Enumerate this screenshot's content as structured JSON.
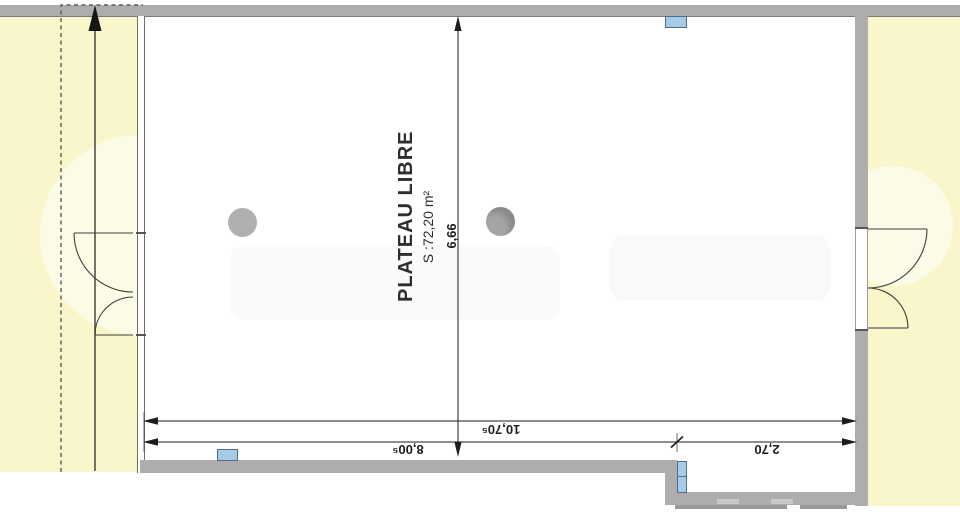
{
  "room": {
    "name": "PLATEAU LIBRE",
    "area": "S :72,20 m²"
  },
  "dimensions": {
    "height": "6,66",
    "total_width": "10,70⁵",
    "main_width": "8,00⁵",
    "alcove_width": "2,70"
  },
  "colors": {
    "exterior_yellow": "#f8f6ca",
    "wall_gray": "#aeacac",
    "fixture_blue": "#a6cbe7",
    "column_light": "#b1afaf",
    "column_dark": "#8e8c8c",
    "dimension_ink": "#1d1d1d"
  }
}
